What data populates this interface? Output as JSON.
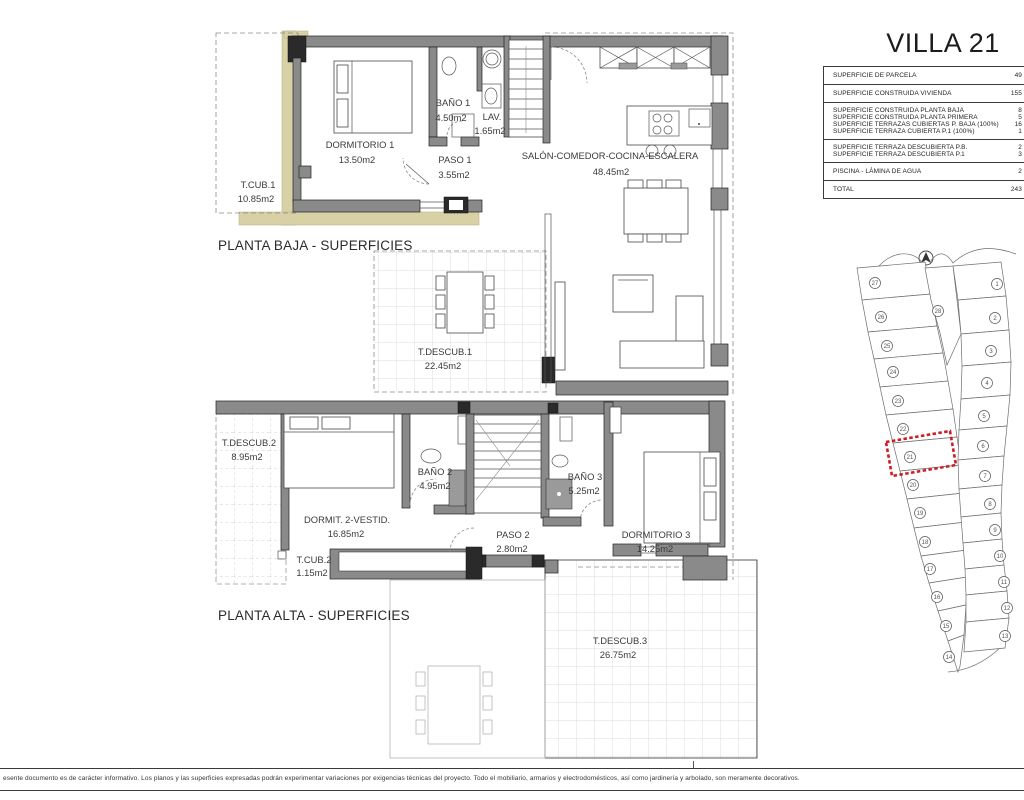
{
  "villa_table": {
    "title": "VILLA 21",
    "groups": [
      {
        "rows": [
          {
            "label": "SUPERFICIE DE PARCELA",
            "value": "49"
          }
        ]
      },
      {
        "rows": [
          {
            "label": "SUPERFICIE CONSTRUIDA VIVIENDA",
            "value": "155"
          }
        ]
      },
      {
        "rows": [
          {
            "label": "SUPERFICIE CONSTRUIDA PLANTA BAJA",
            "value": "8"
          },
          {
            "label": "SUPERFICIE CONSTRUIDA PLANTA PRIMERA",
            "value": "5"
          },
          {
            "label": "SUPERFICIE TERRAZAS CUBIERTAS P. BAJA (100%)",
            "value": "16"
          },
          {
            "label": "SUPERFICIE TERRAZA CUBIERTA P.1 (100%)",
            "value": "1"
          }
        ]
      },
      {
        "rows": [
          {
            "label": "SUPERFICIE TERRAZA DESCUBIERTA P.B.",
            "value": "2"
          },
          {
            "label": "SUPERFICIE TERRAZA DESCUBIERTA P.1",
            "value": "3"
          }
        ]
      },
      {
        "rows": [
          {
            "label": "PISCINA - LÁMINA DE AGUA",
            "value": "2"
          }
        ]
      },
      {
        "rows": [
          {
            "label": "TOTAL",
            "value": "243"
          }
        ]
      }
    ]
  },
  "plans": {
    "ground": {
      "caption": "PLANTA BAJA - SUPERFICIES",
      "rooms": [
        {
          "name": "DORMITORIO 1",
          "area": "13.50m2"
        },
        {
          "name": "BAÑO 1",
          "area": "4.50m2"
        },
        {
          "name": "LAV.",
          "area": "1.65m2"
        },
        {
          "name": "PASO 1",
          "area": "3.55m2"
        },
        {
          "name": "SALÓN-COMEDOR-COCINA-ESCALERA",
          "area": "48.45m2"
        },
        {
          "name": "T.CUB.1",
          "area": "10.85m2"
        },
        {
          "name": "T.DESCUB.1",
          "area": "22.45m2"
        }
      ]
    },
    "upper": {
      "caption": "PLANTA ALTA - SUPERFICIES",
      "rooms": [
        {
          "name": "T.DESCUB.2",
          "area": "8.95m2"
        },
        {
          "name": "DORMIT. 2-VESTID.",
          "area": "16.85m2"
        },
        {
          "name": "BAÑO 2",
          "area": "4.95m2"
        },
        {
          "name": "PASO 2",
          "area": "2.80m2"
        },
        {
          "name": "BAÑO 3",
          "area": "5.25m2"
        },
        {
          "name": "DORMITORIO 3",
          "area": "14.25m2"
        },
        {
          "name": "T.CUB.2",
          "area": "1.15m2"
        },
        {
          "name": "T.DESCUB.3",
          "area": "26.75m2"
        }
      ]
    }
  },
  "site_plan": {
    "highlighted_plot": "21",
    "left_plots": [
      "27",
      "26",
      "25",
      "24",
      "23",
      "22",
      "21",
      "20",
      "19",
      "18",
      "17",
      "16",
      "15",
      "14"
    ],
    "right_plots": [
      "1",
      "2",
      "3",
      "4",
      "5",
      "6",
      "7",
      "8",
      "9",
      "10",
      "11",
      "12",
      "13"
    ],
    "middle_plot": "28",
    "north_icon": "north-arrow-icon",
    "highlight_color": "#cf1d26"
  },
  "disclaimer": "esente documento es de carácter informativo. Los planos y las superficies expresadas podrán experimentar variaciones por exigencias técnicas del proyecto. Todo el mobiliario, armarios y electrodomésticos, así como jardinería y arbolado, son meramente decorativos."
}
